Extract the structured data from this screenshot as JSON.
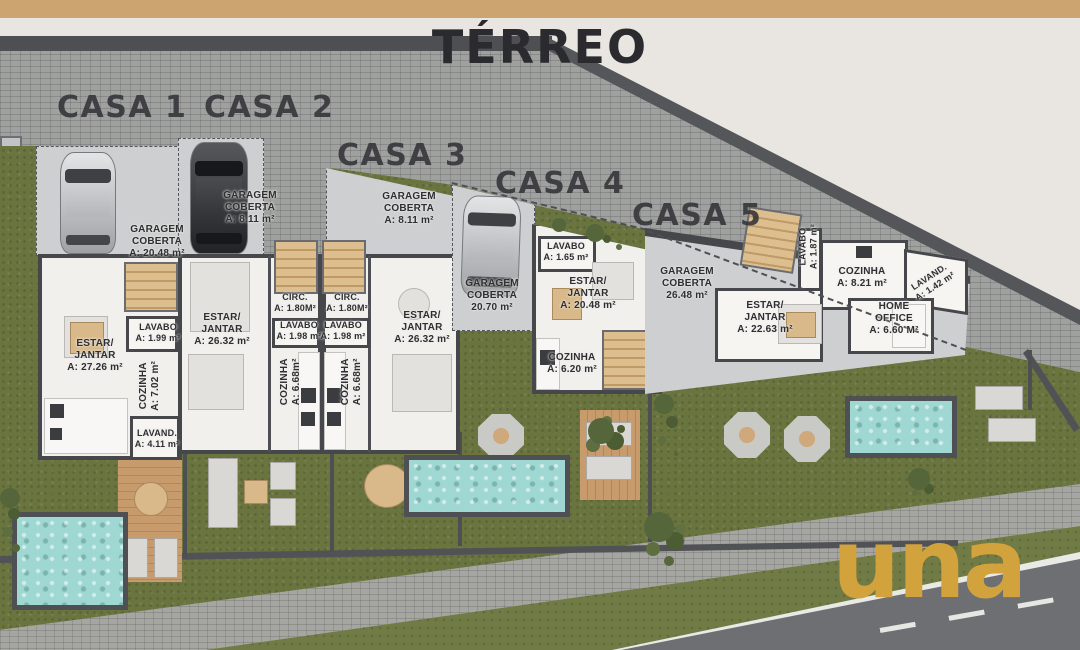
{
  "page": {
    "title": "TÉRREO"
  },
  "branding": {
    "logo_text": "una",
    "logo_color": "#D2A23C",
    "top_bar_color": "#CBA46F"
  },
  "palette": {
    "background": "#E9E6E1",
    "title_color": "#2A2A2F",
    "grass": "#6A743F",
    "pool_water": "#9FD8D3",
    "wood": "#C79B6B",
    "wall_dark": "#46474B",
    "paving": "#9FA19F",
    "floor": "#F1F0ED",
    "slab": "#CDCFD0"
  },
  "houses": [
    {
      "name": "CASA 1",
      "rooms": [
        {
          "name": "garagem-coberta",
          "text": "GARAGEM\nCOBERTA\nA: 20.48 m²"
        },
        {
          "name": "lavabo",
          "text": "LAVABO\nA: 1.99 m²"
        },
        {
          "name": "estar-jantar",
          "text": "ESTAR/\nJANTAR\nA: 27.26 m²"
        },
        {
          "name": "cozinha",
          "text": "COZINHA\nA: 7.02 m²"
        },
        {
          "name": "lavanderia",
          "text": "LAVAND.\nA: 4.11 m²"
        }
      ]
    },
    {
      "name": "CASA 2",
      "rooms": [
        {
          "name": "garagem-coberta",
          "text": "GARAGEM\nCOBERTA\nA: 8.11 m²"
        },
        {
          "name": "circulacao",
          "text": "CIRC.\nA: 1.80M²"
        },
        {
          "name": "lavabo",
          "text": "LAVABO\nA: 1.98 m²"
        },
        {
          "name": "estar-jantar",
          "text": "ESTAR/\nJANTAR\nA: 26.32 m²"
        },
        {
          "name": "cozinha",
          "text": "COZINHA\nA: 6.68m²"
        }
      ]
    },
    {
      "name": "CASA 3",
      "rooms": [
        {
          "name": "garagem-coberta",
          "text": "GARAGEM\nCOBERTA\nA: 8.11 m²"
        },
        {
          "name": "circulacao",
          "text": "CIRC.\nA: 1.80M²"
        },
        {
          "name": "lavabo",
          "text": "LAVABO\nA: 1.98 m²"
        },
        {
          "name": "estar-jantar",
          "text": "ESTAR/\nJANTAR\nA: 26.32 m²"
        },
        {
          "name": "cozinha",
          "text": "COZINHA\nA: 6.68m²"
        }
      ]
    },
    {
      "name": "CASA 4",
      "rooms": [
        {
          "name": "garagem-coberta",
          "text": "GARAGEM\nCOBERTA\n20.70 m²"
        },
        {
          "name": "lavabo",
          "text": "LAVABO\nA: 1.65 m²"
        },
        {
          "name": "estar-jantar",
          "text": "ESTAR/\nJANTAR\nA: 20.48 m²"
        },
        {
          "name": "cozinha",
          "text": "COZINHA\nA: 6.20 m²"
        }
      ]
    },
    {
      "name": "CASA 5",
      "rooms": [
        {
          "name": "garagem-coberta",
          "text": "GARAGEM\nCOBERTA\n26.48 m²"
        },
        {
          "name": "lavabo",
          "text": "LAVABO\nA: 1.87 m²"
        },
        {
          "name": "cozinha",
          "text": "COZINHA\nA: 8.21 m²"
        },
        {
          "name": "lavanderia",
          "text": "LAVAND.\nA: 1.42 m²"
        },
        {
          "name": "estar-jantar",
          "text": "ESTAR/\nJANTAR\nA: 22.63 m²"
        },
        {
          "name": "home-office",
          "text": "HOME\nOFFICE\nA: 6.60 M²"
        }
      ]
    }
  ]
}
